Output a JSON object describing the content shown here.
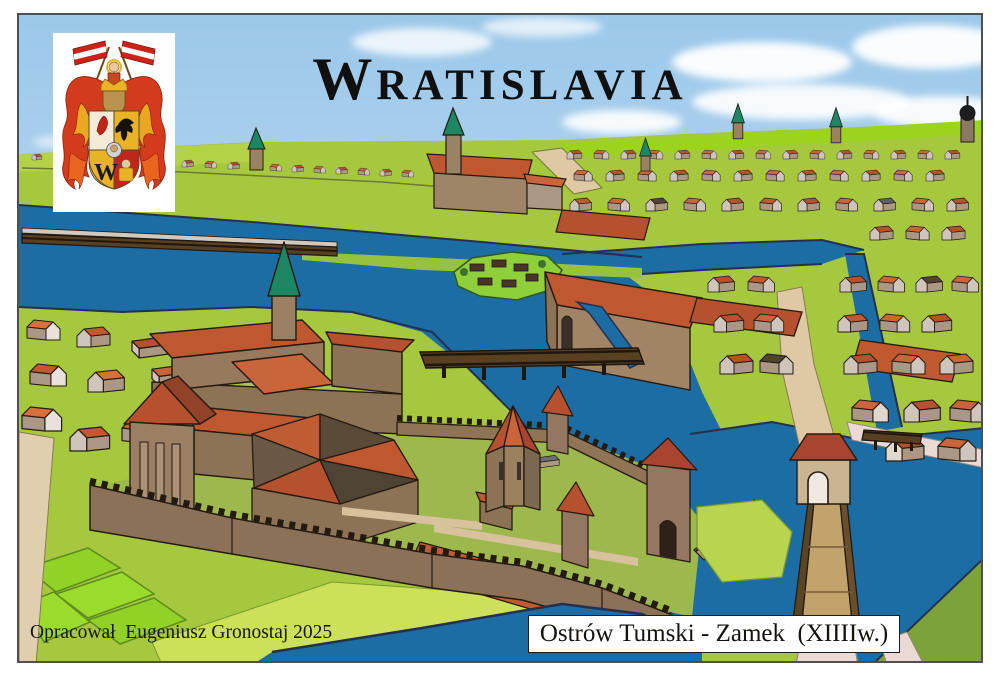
{
  "title": {
    "initial": "W",
    "rest": "RATISLAVIA"
  },
  "attribution": "Opracował  Eugeniusz Gronostaj 2025",
  "caption": "Ostrów Tumski - Zamek  (XIIIIw.)",
  "coat_of_arms": {
    "name": "wroclaw-coat-of-arms",
    "monogram": "W"
  },
  "palette": {
    "sky_top": "#9cc8ea",
    "sky_horizon": "#e6f2fa",
    "cloud": "#ffffff",
    "river": "#1c6da3",
    "river_edge": "#25304e",
    "field": "#a6c83e",
    "field_bright": "#92d226",
    "horizon_lime": "#9ad41f",
    "bank_bright": "#cde05a",
    "field_olive": "#7ca23c",
    "roof_red": "#b5512e",
    "roof_orange": "#c9653a",
    "roof_bright": "#d8703d",
    "roof_dark": "#4f4336",
    "roof_gray": "#5b6069",
    "wall_light": "#cfc5bd",
    "wall_tan": "#ab9786",
    "wall_brown": "#8d7356",
    "castle_wall": "#8a7157",
    "road": "#dfc9a4",
    "road_pink": "#ead9d4",
    "bridge_wood": "#2a1d10",
    "bridge_deck": "#b99b6d",
    "spire_teal": "#1d8663",
    "outline": "#241a10",
    "coa_red": "#d43b1c",
    "coa_gold": "#e9b327"
  }
}
